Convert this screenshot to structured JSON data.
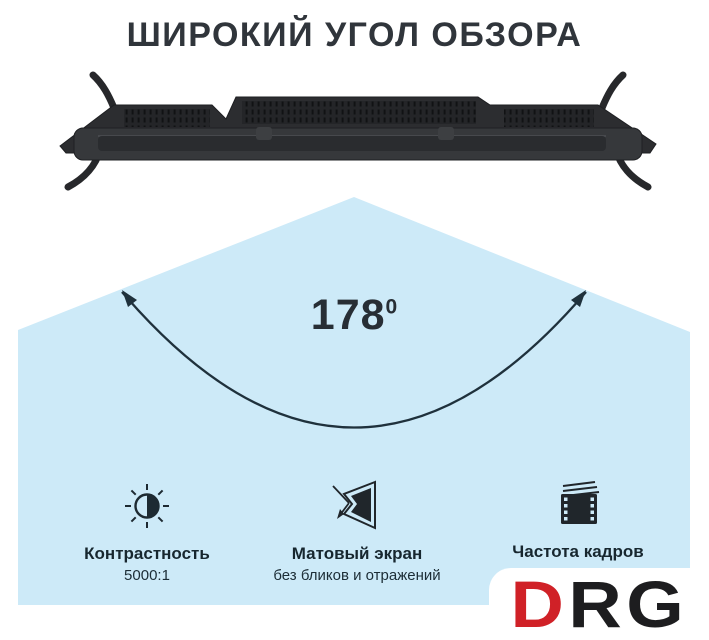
{
  "title": "ШИРОКИЙ УГОЛ ОБЗОРА",
  "viewing_angle": {
    "value": "178",
    "superscript": "0"
  },
  "features": [
    {
      "icon": "contrast-icon",
      "label": "Контрастность",
      "sublabel": "5000:1"
    },
    {
      "icon": "matte-screen-icon",
      "label": "Матовый экран",
      "sublabel": "без бликов и отражений"
    },
    {
      "icon": "frame-rate-icon",
      "label": "Частота кадров"
    }
  ],
  "brand": {
    "letter_red": "D",
    "letters_dark": "RG"
  },
  "colors": {
    "cone_blue": "#cdeaf8",
    "title_dark": "#30353b",
    "label_navy": "#17272f",
    "arc_dark": "#1f313c",
    "brand_red": "#d02127",
    "brand_dark": "#1d1d1f",
    "tv_body": "#2c2d30"
  }
}
